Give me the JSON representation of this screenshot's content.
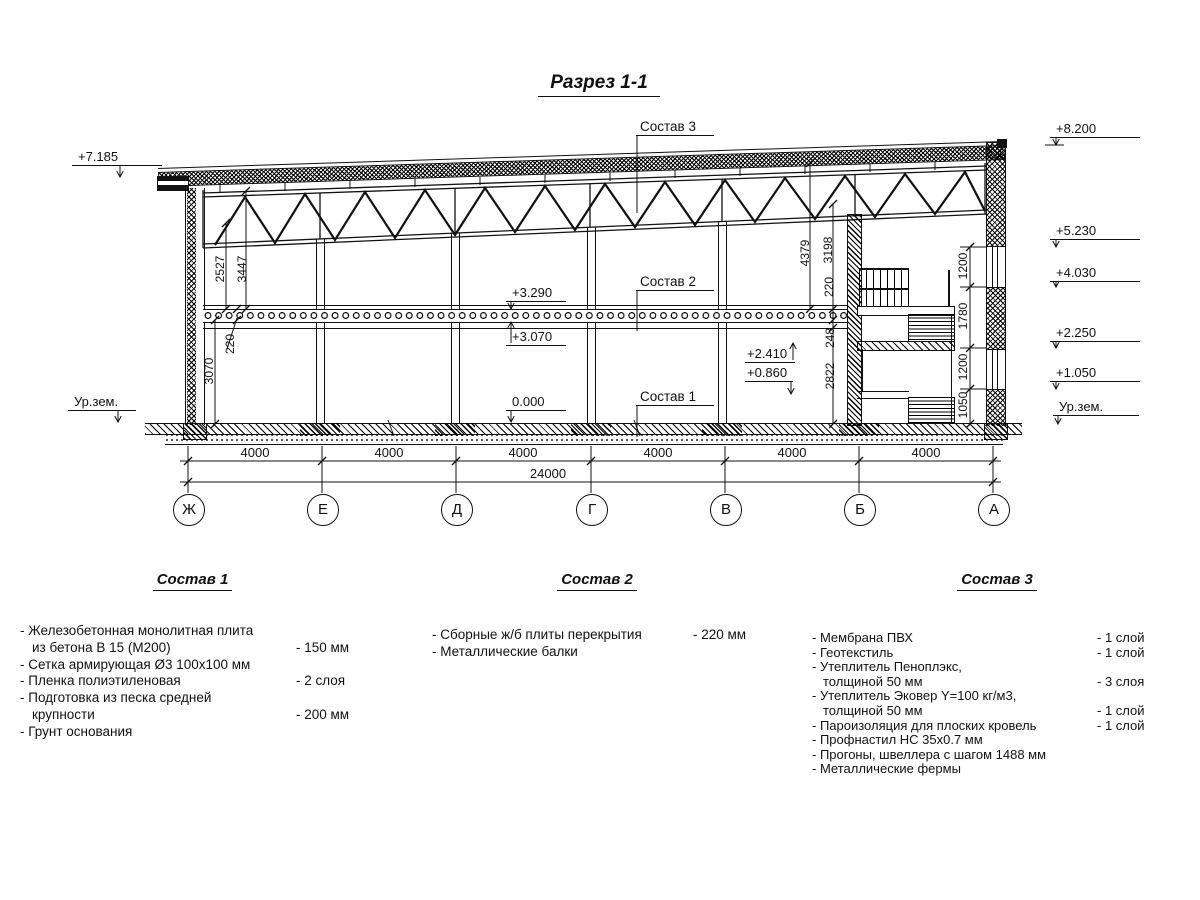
{
  "title": "Разрез 1-1",
  "ground_left": "Ур.зем.",
  "ground_right": "Ур.зем.",
  "elevations": {
    "left_roof": "+7.185",
    "right_parapet": "+8.200",
    "right_win2_top": "+5.230",
    "right_win2_sill": "+4.030",
    "right_win1_top": "+2.250",
    "right_win1_sill": "+1.050",
    "slab_top": "+3.290",
    "slab_bottom": "+3.070",
    "floor": "0.000",
    "stair_upper": "+2.410",
    "stair_lower": "+0.860"
  },
  "callouts": {
    "c3": "Состав 3",
    "c2": "Состав 2",
    "c1": "Состав 1"
  },
  "dims": {
    "left_2527": "2527",
    "left_3447": "3447",
    "left_220": "220",
    "left_3070": "3070",
    "right_4379": "4379",
    "right_3198": "3198",
    "right_220": "220",
    "right_248": "248",
    "right_2822": "2822",
    "wall_1200a": "1200",
    "wall_1780": "1780",
    "wall_1200b": "1200",
    "wall_1050": "1050",
    "spans": [
      "4000",
      "4000",
      "4000",
      "4000",
      "4000",
      "4000"
    ],
    "total": "24000"
  },
  "axes": [
    "Ж",
    "Е",
    "Д",
    "Г",
    "В",
    "Б",
    "А"
  ],
  "legend": {
    "blocks": [
      {
        "title": "Состав 1",
        "items": [
          {
            "text": "- Железобетонная  монолитная плита"
          },
          {
            "text": "из бетона В 15 (М200)",
            "value": "- 150 мм"
          },
          {
            "text": "- Сетка армирующая Ø3 100х100 мм"
          },
          {
            "text": "- Пленка полиэтиленовая",
            "value": "-  2 слоя"
          },
          {
            "text": "- Подготовка из песка средней"
          },
          {
            "text": "крупности",
            "value": "- 200 мм"
          },
          {
            "text": "- Грунт основания"
          }
        ]
      },
      {
        "title": "Состав 2",
        "items": [
          {
            "text": "- Сборные ж/б плиты перекрытия",
            "value": "- 220 мм"
          },
          {
            "text": "- Металлические балки"
          }
        ]
      },
      {
        "title": "Состав 3",
        "items": [
          {
            "text": "- Мембрана ПВХ",
            "value": "- 1 слой"
          },
          {
            "text": "- Геотекстиль",
            "value": "- 1 слой"
          },
          {
            "text": "- Утеплитель Пеноплэкс,"
          },
          {
            "text": "толщиной 50 мм",
            "value": "- 3 слоя"
          },
          {
            "text": "- Утеплитель Эковер Y=100 кг/м3,"
          },
          {
            "text": "толщиной 50 мм",
            "value": "- 1 слой"
          },
          {
            "text": "- Пароизоляция для плоских кровель",
            "value": "- 1 слой"
          },
          {
            "text": "- Профнастил НС 35х0.7 мм"
          },
          {
            "text": "- Прогоны, швеллера с шагом 1488 мм"
          },
          {
            "text": "- Металлические фермы"
          }
        ]
      }
    ]
  }
}
